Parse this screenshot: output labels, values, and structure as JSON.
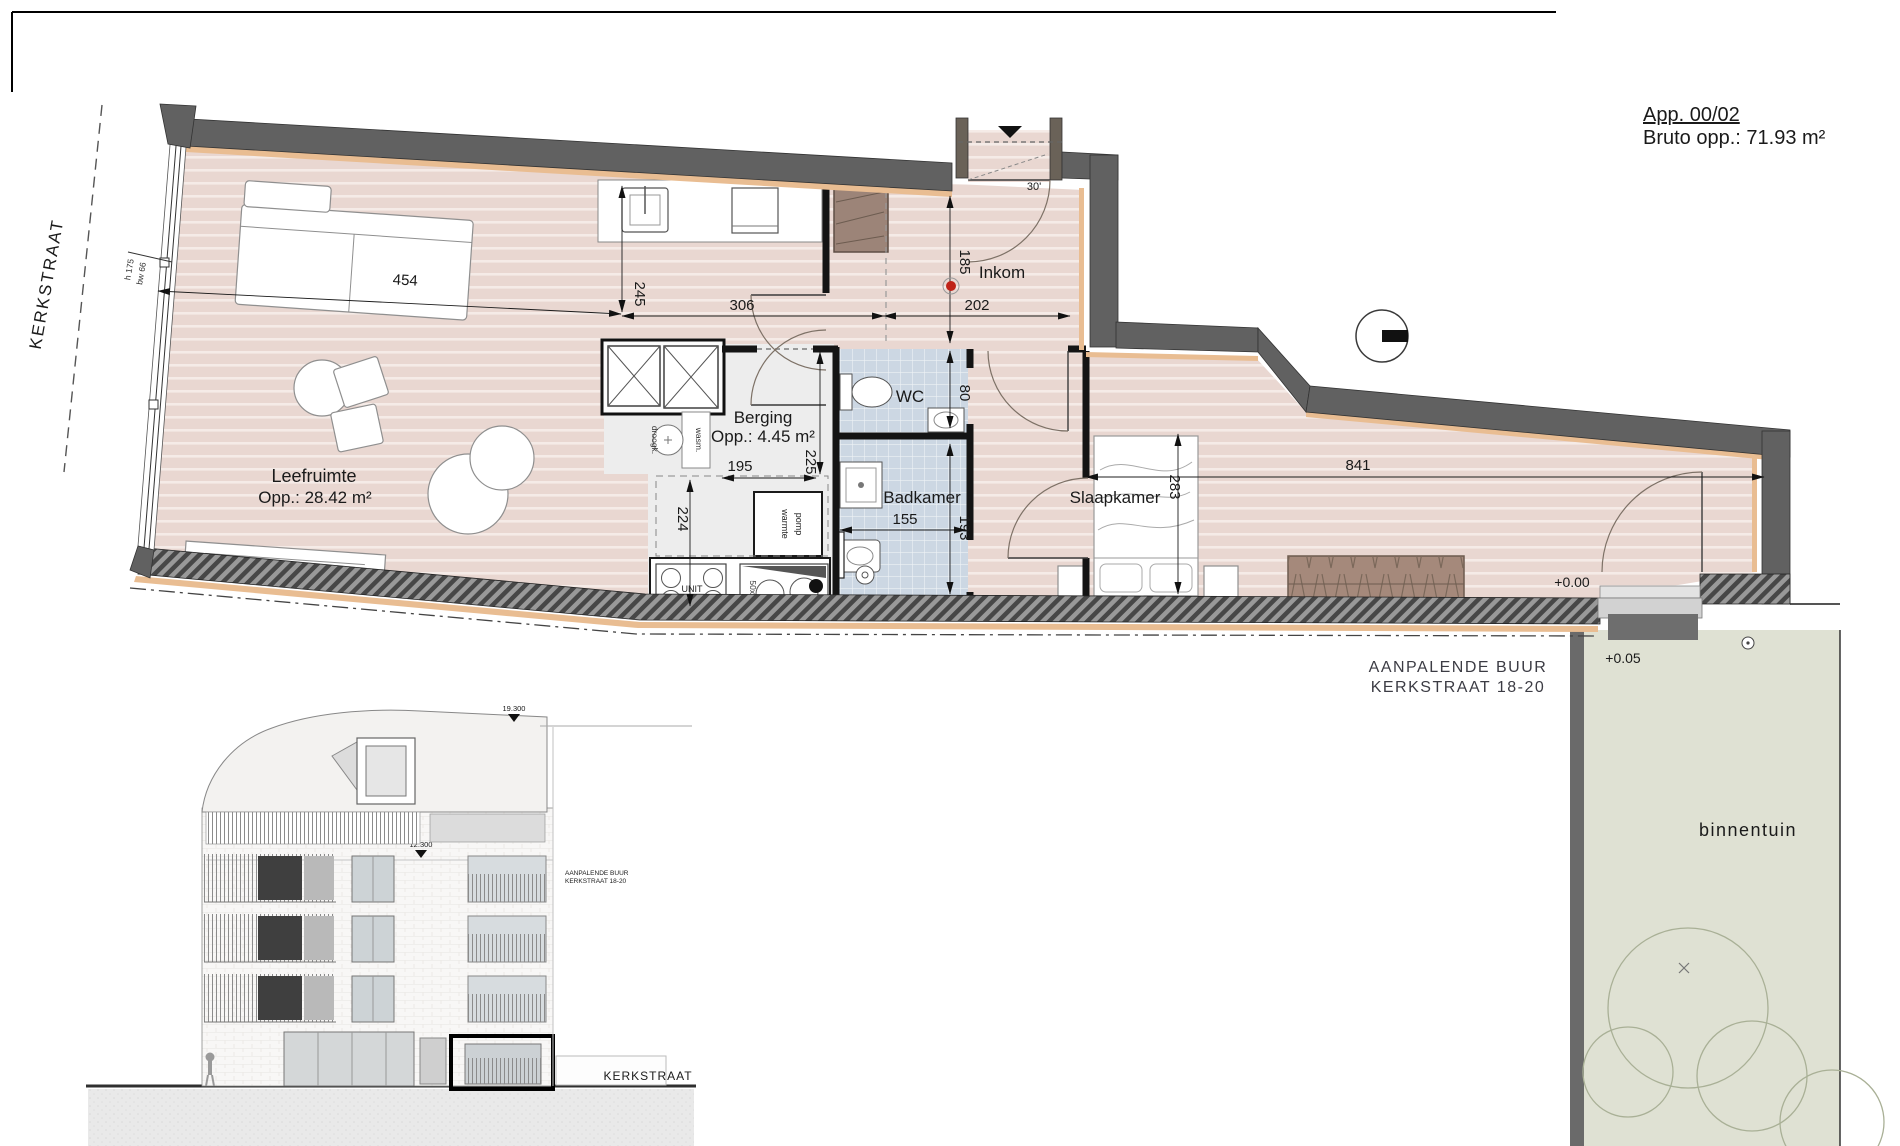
{
  "title_block": {
    "app": "App. 00/02",
    "area": "Bruto opp.: 71.93 m²"
  },
  "street": {
    "side_label": "KERKSTRAAT"
  },
  "plan": {
    "rooms": {
      "leefruimte": {
        "name": "Leefruimte",
        "area": "Opp.: 28.42 m²"
      },
      "berging": {
        "name": "Berging",
        "area": "Opp.: 4.45 m²"
      },
      "wc": {
        "name": "WC"
      },
      "badkamer": {
        "name": "Badkamer"
      },
      "inkom": {
        "name": "Inkom"
      },
      "slaapkamer": {
        "name": "Slaapkamer"
      }
    },
    "dims": {
      "d454": "454",
      "d245": "245",
      "d306": "306",
      "d202": "202",
      "d185": "185",
      "d80": "80",
      "d225": "225",
      "d195": "195",
      "d224": "224",
      "d155": "155",
      "d193": "193",
      "d283": "283",
      "d841": "841"
    },
    "annotations": {
      "window_h": "h 175",
      "window_bw": "bw 66",
      "door_angle": "30'",
      "unit": "UNIT",
      "sink_size": "50x90",
      "heat_pump_1": "warmte",
      "heat_pump_2": "pomp",
      "washer": "wasm.",
      "dryer": "droogk.",
      "level_ground": "+0.00",
      "level_garden": "+0.05"
    },
    "neighbor": {
      "line1": "AANPALENDE BUUR",
      "line2": "KERKSTRAAT 18-20"
    },
    "garden": {
      "label": "binnentuin"
    }
  },
  "elevation": {
    "level_top": "19.300",
    "level_mid": "12.300",
    "note1": "AANPALENDE BUUR",
    "note2": "KERKSTRAAT 18-20",
    "street_label": "KERKSTRAAT"
  },
  "colors": {
    "wall": "#616161",
    "insulation": "#e9bd92",
    "wood_floor": "#e9d7d1",
    "tile_floor": "#ccd7e3",
    "utility_floor": "#ededed",
    "garden": "#dfe1d3",
    "wardrobe": "#a5897b",
    "closet": "#9c8478",
    "detector_red": "#bf2318"
  }
}
